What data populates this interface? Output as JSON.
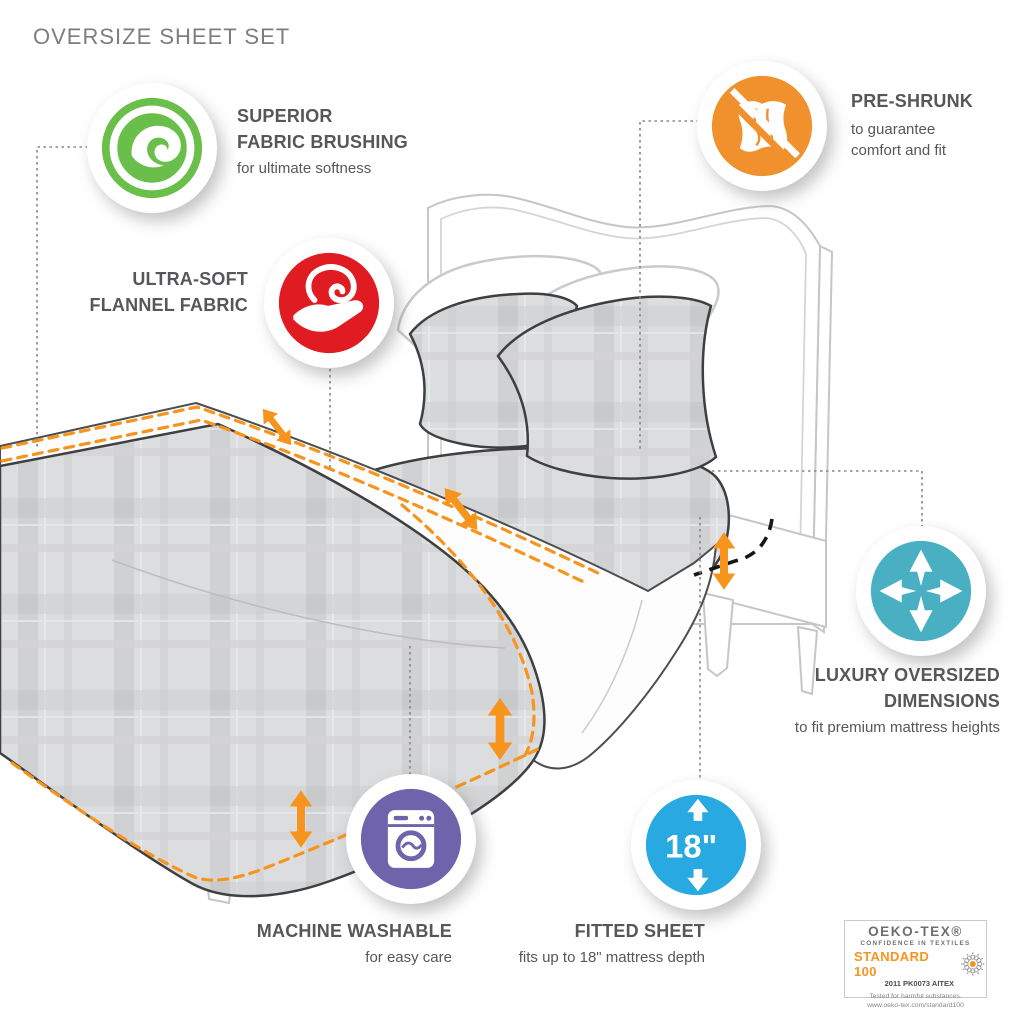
{
  "page": {
    "title": "OVERSIZE SHEET SET"
  },
  "features": [
    {
      "id": "superior-fabric-brushing",
      "icon": "fabric-brushing-swirl-icon",
      "color": "#6abf4b",
      "title_lines": [
        "SUPERIOR",
        "FABRIC BRUSHING"
      ],
      "sub_lines": [
        "for ultimate softness"
      ]
    },
    {
      "id": "ultra-soft-flannel-fabric",
      "icon": "hand-holding-fabric-icon",
      "color": "#e11b22",
      "title_lines": [
        "ULTRA-SOFT",
        "FLANNEL FABRIC"
      ],
      "sub_lines": []
    },
    {
      "id": "pre-shrunk",
      "icon": "no-shrink-fabric-icon",
      "color": "#f0912d",
      "title_lines": [
        "PRE-SHRUNK"
      ],
      "sub_lines": [
        "to guarantee",
        "comfort and fit"
      ]
    },
    {
      "id": "luxury-oversized-dimensions",
      "icon": "expand-arrows-icon",
      "color": "#48b0c2",
      "title_lines": [
        "LUXURY OVERSIZED",
        "DIMENSIONS"
      ],
      "sub_lines": [
        "to fit premium mattress heights"
      ]
    },
    {
      "id": "machine-washable",
      "icon": "washing-machine-icon",
      "color": "#6f63ab",
      "title_lines": [
        "MACHINE WASHABLE"
      ],
      "sub_lines": [
        "for easy care"
      ]
    },
    {
      "id": "fitted-sheet",
      "icon": "mattress-depth-arrows-icon",
      "color": "#29a9e1",
      "badge_text": "18\"",
      "title_lines": [
        "FITTED SHEET"
      ],
      "sub_lines": [
        "fits up to 18\" mattress depth"
      ]
    }
  ],
  "certification": {
    "brand": "OEKO-TEX®",
    "tagline": "CONFIDENCE IN TEXTILES",
    "standard": "STANDARD 100",
    "standard_color": "#f7941d",
    "certificate": "2011 PK0073 AITEX",
    "note": "Tested for harmful substances.",
    "url": "www.oeko-tex.com/standard100",
    "flower_icon": "oeko-flower-icon"
  },
  "illustration": {
    "accent_color": "#f7941d",
    "subject": "bed with oversized sheet set"
  }
}
